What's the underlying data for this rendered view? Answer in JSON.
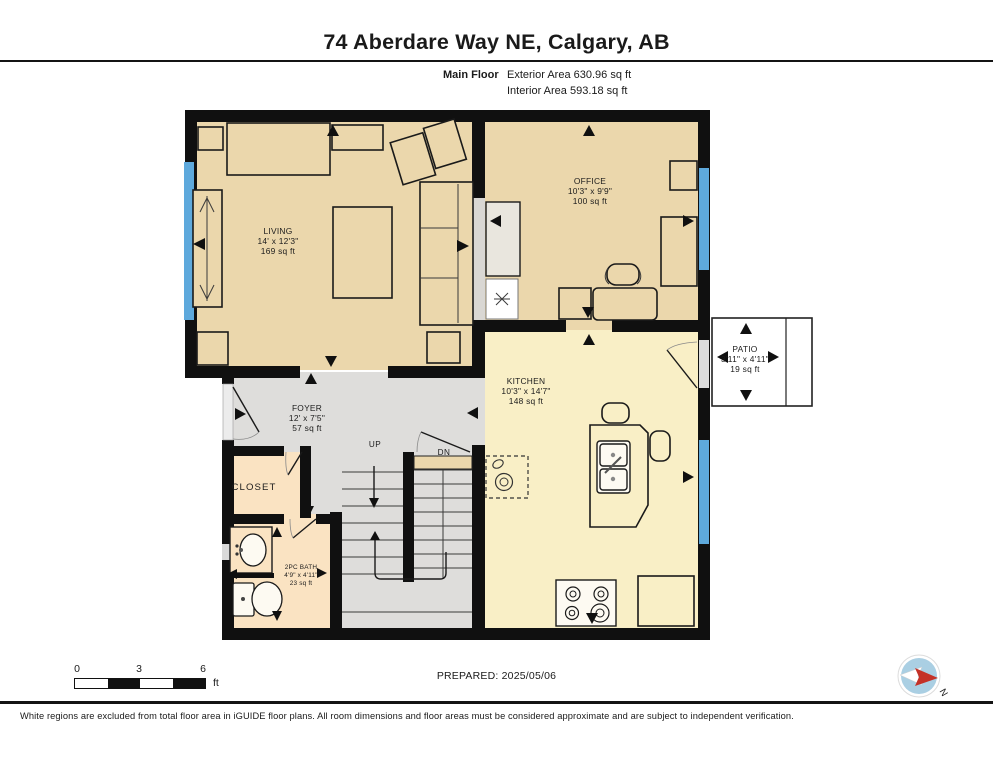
{
  "header": {
    "title": "74 Aberdare Way NE, Calgary, AB",
    "floor_label": "Main Floor",
    "exterior_area": "Exterior Area 630.96 sq ft",
    "interior_area": "Interior Area 593.18 sq ft"
  },
  "rooms": {
    "living": {
      "name": "LIVING",
      "dims": "14' x 12'3\"",
      "area": "169 sq ft"
    },
    "office": {
      "name": "OFFICE",
      "dims": "10'3\" x 9'9\"",
      "area": "100 sq ft"
    },
    "kitchen": {
      "name": "KITCHEN",
      "dims": "10'3\" x 14'7\"",
      "area": "148 sq ft"
    },
    "foyer": {
      "name": "FOYER",
      "dims": "12' x 7'5\"",
      "area": "57 sq ft"
    },
    "patio": {
      "name": "PATIO",
      "dims": "3'11\" x 4'11\"",
      "area": "19 sq ft"
    },
    "bath": {
      "name": "2PC BATH",
      "dims": "4'9\" x 4'11\"",
      "area": "23 sq ft"
    },
    "closet": {
      "name": "CLOSET"
    }
  },
  "stairs": {
    "up": "UP",
    "dn": "DN"
  },
  "scale_bar": {
    "tick0": "0",
    "tick3": "3",
    "tick6": "6",
    "unit": "ft"
  },
  "footer": {
    "prepared": "PREPARED: 2025/05/06",
    "compass_north_label": "N",
    "disclaimer": "White regions are excluded from total floor area in iGUIDE floor plans. All room dimensions and floor areas must be considered approximate and are subject to independent verification."
  },
  "colors": {
    "room_tan": "#ebd7ac",
    "room_yellow": "#f9efc6",
    "room_peach": "#fae3c2",
    "hall_gray": "#dedddb",
    "wall_black": "#101010",
    "window_blue": "#5ea9dc",
    "compass_blue": "#aacfe3",
    "compass_red": "#c43127"
  }
}
